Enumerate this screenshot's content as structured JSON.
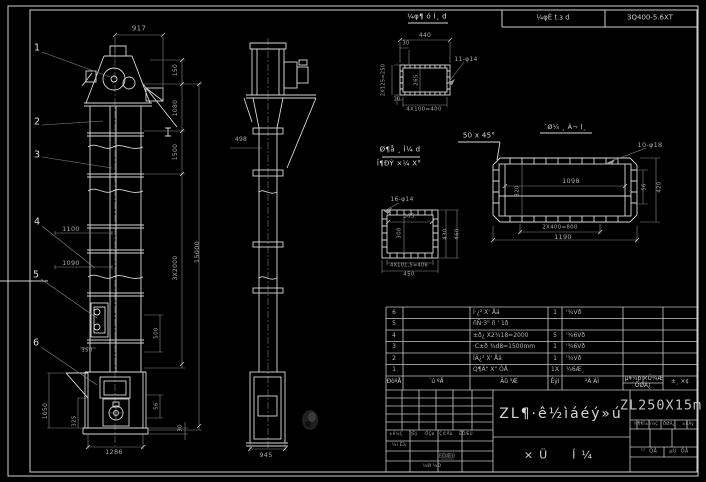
{
  "header": {
    "cell1": "¼φÈ t.з d",
    "cell2": "3Q400-5.6XT"
  },
  "titleblock": {
    "title": "ZL¶·ê½ìáéý»ú",
    "subtitle": "×Ü  Í¼",
    "drawing_no": "ZL250X15m"
  },
  "colors": {
    "background": "#000000",
    "line": "#d9d9d9",
    "dim": "#8d8d8d"
  },
  "front_view": {
    "balloons": [
      {
        "n": "1",
        "x": 37,
        "y": 48
      },
      {
        "n": "2",
        "x": 37,
        "y": 122
      },
      {
        "n": "3",
        "x": 37,
        "y": 155
      },
      {
        "n": "4",
        "x": 37,
        "y": 222
      },
      {
        "n": "5",
        "x": 36,
        "y": 275
      },
      {
        "n": "6",
        "x": 36,
        "y": 343
      }
    ]
  },
  "bom": {
    "headers": [
      "ÐòºÅ",
      "´ú ºÅ",
      "Ãû ³Æ",
      "Êýl",
      "²Ä ÁÏ",
      "µ¥¼þ",
      "×Ü¼Æ",
      "ÖØÁ¿",
      "±¸ ×¢"
    ],
    "rows": [
      {
        "no": "6",
        "code": "",
        "name": "Í·¿² X' Åä",
        "qty": "1",
        "mat": "'¾Vð"
      },
      {
        "no": "5",
        "code": "",
        "name": "ñÑ·3\" ñ ' 1ð",
        "qty": "",
        "mat": ""
      },
      {
        "no": "4",
        "code": "",
        "name": "±ð¿ X2¾18=2000",
        "qty": "5",
        "mat": "'¾6Vð"
      },
      {
        "no": "3",
        "code": "",
        "name": "·C±ð ¾d8=1500mm",
        "qty": "1",
        "mat": "'¾6Vð"
      },
      {
        "no": "2",
        "code": "",
        "name": "ÏÂ¿² X' Åä",
        "qty": "1",
        "mat": "'¾Vð"
      },
      {
        "no": "1",
        "code": "",
        "name": "Q¶Ä\" X\" ÓÅ",
        "qty": "1X",
        "mat": "¼6Æ¸"
      }
    ]
  },
  "labels": [
    {
      "t": "917",
      "x": 139,
      "y": 29,
      "s": 7
    },
    {
      "t": "150",
      "x": 176,
      "y": 70,
      "r": -90,
      "s": 6
    },
    {
      "t": "1080",
      "x": 176,
      "y": 108,
      "r": -90,
      "s": 6
    },
    {
      "t": "1500",
      "x": 176,
      "y": 152,
      "r": -90,
      "s": 6
    },
    {
      "t": "3X2000",
      "x": 176,
      "y": 268,
      "r": -90,
      "s": 6
    },
    {
      "t": "15000",
      "x": 197,
      "y": 252,
      "r": -90,
      "s": 6.5
    },
    {
      "t": "1100",
      "x": 71,
      "y": 229,
      "s": 6.5
    },
    {
      "t": "1090",
      "x": 71,
      "y": 263,
      "s": 6.5
    },
    {
      "t": "350",
      "x": 87,
      "y": 351,
      "s": 5.5
    },
    {
      "t": "1050",
      "x": 46,
      "y": 411,
      "r": -90,
      "s": 6
    },
    {
      "t": "325",
      "x": 75,
      "y": 421,
      "r": -90,
      "s": 5.5
    },
    {
      "t": "1286",
      "x": 114,
      "y": 452,
      "s": 6.5
    },
    {
      "t": "500",
      "x": 157,
      "y": 333,
      "r": -90,
      "s": 5.5
    },
    {
      "t": "56",
      "x": 157,
      "y": 406,
      "r": -90,
      "s": 5.5
    },
    {
      "t": "30",
      "x": 181,
      "y": 428,
      "r": -90,
      "s": 5.5
    },
    {
      "t": "498",
      "x": 241,
      "y": 140,
      "s": 6
    },
    {
      "t": "945",
      "x": 266,
      "y": 455,
      "s": 6.5
    },
    {
      "t": "¼φ¶ ó Ì¸ d",
      "x": 427,
      "y": 17,
      "s": 7,
      "c": "w"
    },
    {
      "t": "440",
      "x": 425,
      "y": 36,
      "s": 6
    },
    {
      "t": "30",
      "x": 406,
      "y": 44,
      "s": 5
    },
    {
      "t": "2X125=250",
      "x": 384,
      "y": 80,
      "r": -90,
      "s": 5
    },
    {
      "t": "265",
      "x": 417,
      "y": 80,
      "r": -90,
      "s": 5.5
    },
    {
      "t": "10",
      "x": 397,
      "y": 100,
      "s": 5
    },
    {
      "t": "4X100=400",
      "x": 424,
      "y": 110,
      "s": 5.5
    },
    {
      "t": "11-φ14",
      "x": 466,
      "y": 60,
      "s": 6
    },
    {
      "t": "Ø¶å ¸ Ì¼ d",
      "x": 400,
      "y": 150,
      "s": 7,
      "c": "w"
    },
    {
      "t": "Î¶ÐÝ ×¼ X°",
      "x": 399,
      "y": 164,
      "s": 7,
      "c": "w"
    },
    {
      "t": "50 x 45°",
      "x": 479,
      "y": 136,
      "s": 7,
      "c": "w"
    },
    {
      "t": "16-φ14",
      "x": 402,
      "y": 200,
      "s": 6
    },
    {
      "t": "365",
      "x": 409,
      "y": 217,
      "s": 5.5
    },
    {
      "t": "300",
      "x": 400,
      "y": 233,
      "r": -90,
      "s": 5.5
    },
    {
      "t": "430",
      "x": 446,
      "y": 234,
      "r": -90,
      "s": 5.5
    },
    {
      "t": "460",
      "x": 458,
      "y": 234,
      "r": -90,
      "s": 5.5
    },
    {
      "t": "4X101.5=406",
      "x": 409,
      "y": 266,
      "s": 5
    },
    {
      "t": "450",
      "x": 409,
      "y": 275,
      "s": 5.5
    },
    {
      "t": "´Ø¼ ¸ Á¬ l¸",
      "x": 565,
      "y": 127,
      "s": 6.5,
      "c": "w"
    },
    {
      "t": "10-φ18",
      "x": 650,
      "y": 145,
      "s": 6.5
    },
    {
      "t": "1098",
      "x": 571,
      "y": 181,
      "s": 6.5
    },
    {
      "t": "320",
      "x": 518,
      "y": 191,
      "r": -90,
      "s": 5.5
    },
    {
      "t": "56",
      "x": 645,
      "y": 187,
      "r": -90,
      "s": 5.5
    },
    {
      "t": "420",
      "x": 660,
      "y": 187,
      "r": -90,
      "s": 5.5
    },
    {
      "t": "2X400=800",
      "x": 560,
      "y": 228,
      "s": 5.5
    },
    {
      "t": "1190",
      "x": 563,
      "y": 237,
      "s": 6.5
    },
    {
      "t": "±ê¼Ç",
      "x": 396,
      "y": 434,
      "s": 4,
      "c": "d"
    },
    {
      "t": "´¦Êý",
      "x": 413,
      "y": 434,
      "s": 4,
      "c": "d"
    },
    {
      "t": "·ÖÇø",
      "x": 429,
      "y": 434,
      "s": 4,
      "c": "d"
    },
    {
      "t": "Ç©Ãû",
      "x": 446,
      "y": 434,
      "s": 4,
      "c": "d"
    },
    {
      "t": "ÈÕÆÚ",
      "x": 466,
      "y": 434,
      "s": 4,
      "c": "d"
    },
    {
      "t": "¼ì Êä",
      "x": 399,
      "y": 446,
      "s": 4.5,
      "c": "d"
    },
    {
      "t": "ÈÕÆÚ",
      "x": 447,
      "y": 457,
      "s": 5,
      "c": "g"
    },
    {
      "t": "¼Ø ¼Ð",
      "x": 432,
      "y": 467,
      "s": 4.5,
      "c": "d"
    },
    {
      "t": "¼¶¶Î±ê¼Ç",
      "x": 646,
      "y": 424,
      "s": 4,
      "c": "d"
    },
    {
      "t": "ÖØÁ¿",
      "x": 669,
      "y": 424,
      "s": 4,
      "c": "d"
    },
    {
      "t": "±ÈÀý",
      "x": 688,
      "y": 424,
      "s": 4,
      "c": "d"
    },
    {
      "t": "¹²  ÕÅ",
      "x": 649,
      "y": 452,
      "s": 5,
      "c": "d"
    },
    {
      "t": "µÚ  ÕÅ",
      "x": 679,
      "y": 452,
      "s": 5,
      "c": "d"
    }
  ]
}
